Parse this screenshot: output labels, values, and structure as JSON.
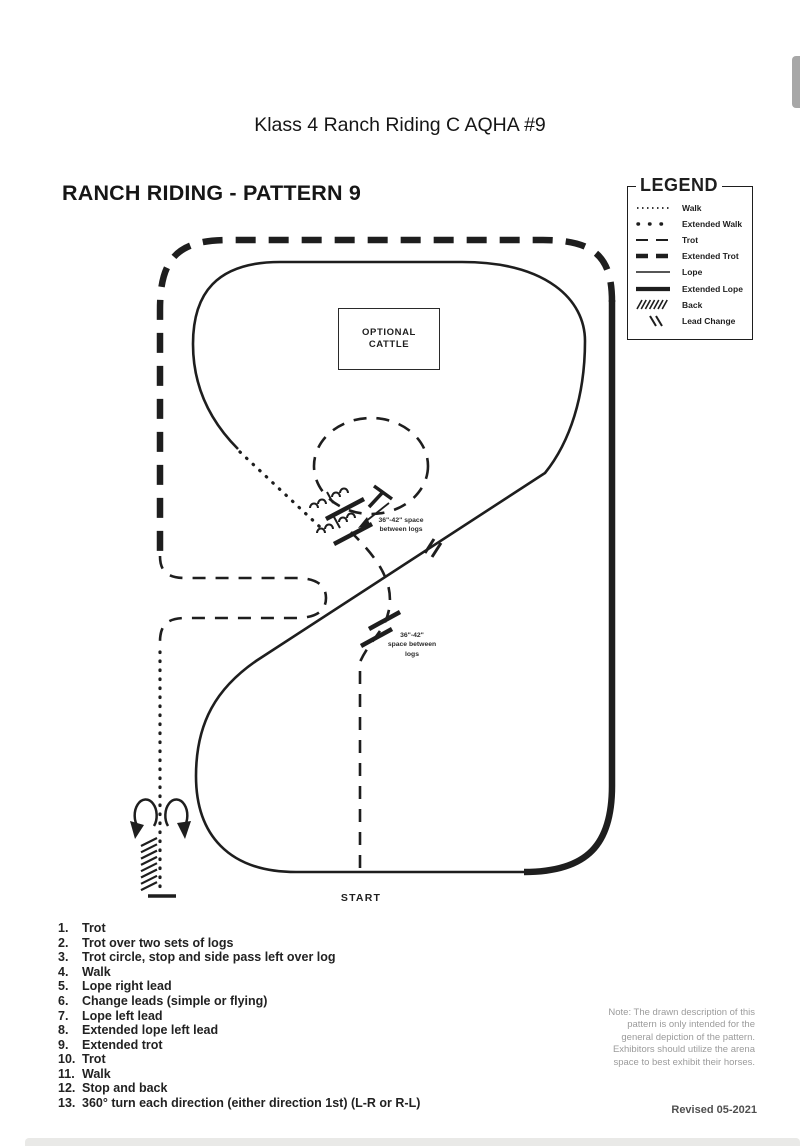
{
  "page": {
    "title": "Klass 4 Ranch Riding C AQHA #9"
  },
  "pattern": {
    "heading": "RANCH RIDING - PATTERN 9",
    "optional_cattle": {
      "line1": "OPTIONAL",
      "line2": "CATTLE"
    },
    "start_label": "START",
    "log_note_upper": {
      "line1": "36\"-42\" space",
      "line2": "between logs"
    },
    "log_note_lower": {
      "line1": "36\"-42\"",
      "line2": "space between",
      "line3": "logs"
    }
  },
  "legend": {
    "title": "LEGEND",
    "items": [
      {
        "symbol": "walk-dotted-line",
        "label": "Walk"
      },
      {
        "symbol": "extended-walk-spaced-dots",
        "label": "Extended Walk"
      },
      {
        "symbol": "trot-dashed-line",
        "label": "Trot"
      },
      {
        "symbol": "extended-trot-thick-dashed-line",
        "label": "Extended Trot"
      },
      {
        "symbol": "lope-thin-solid-line",
        "label": "Lope"
      },
      {
        "symbol": "extended-lope-thick-solid-line",
        "label": "Extended Lope"
      },
      {
        "symbol": "back-hatch-marks",
        "label": "Back"
      },
      {
        "symbol": "lead-change-double-slash",
        "label": "Lead Change"
      }
    ]
  },
  "instructions": {
    "items": [
      {
        "num": "1.",
        "text": "Trot"
      },
      {
        "num": "2.",
        "text": "Trot over two sets of logs"
      },
      {
        "num": "3.",
        "text": "Trot circle, stop and side pass left over log"
      },
      {
        "num": "4.",
        "text": "Walk"
      },
      {
        "num": "5.",
        "text": "Lope right lead"
      },
      {
        "num": "6.",
        "text": "Change leads (simple or flying)"
      },
      {
        "num": "7.",
        "text": "Lope left lead"
      },
      {
        "num": "8.",
        "text": "Extended lope left lead"
      },
      {
        "num": "9.",
        "text": "Extended trot"
      },
      {
        "num": "10.",
        "text": "Trot"
      },
      {
        "num": "11.",
        "text": "Walk"
      },
      {
        "num": "12.",
        "text": "Stop and back"
      },
      {
        "num": "13.",
        "text": "360° turn each direction (either direction 1st) (L-R or R-L)"
      }
    ]
  },
  "note": {
    "lines": [
      "Note: The drawn description of this",
      "pattern is only intended for the",
      "general depiction of the pattern.",
      "Exhibitors should utilize the arena",
      "space to best exhibit their horses."
    ]
  },
  "footer": {
    "revised": "Revised 05-2021"
  },
  "colors": {
    "ink": "#1e1e1e",
    "note_gray": "#9b9b9b",
    "revised_gray": "#4f4f4f",
    "scrollbar_thumb": "#a7a7a7",
    "page_divider": "#e9e9e7"
  }
}
